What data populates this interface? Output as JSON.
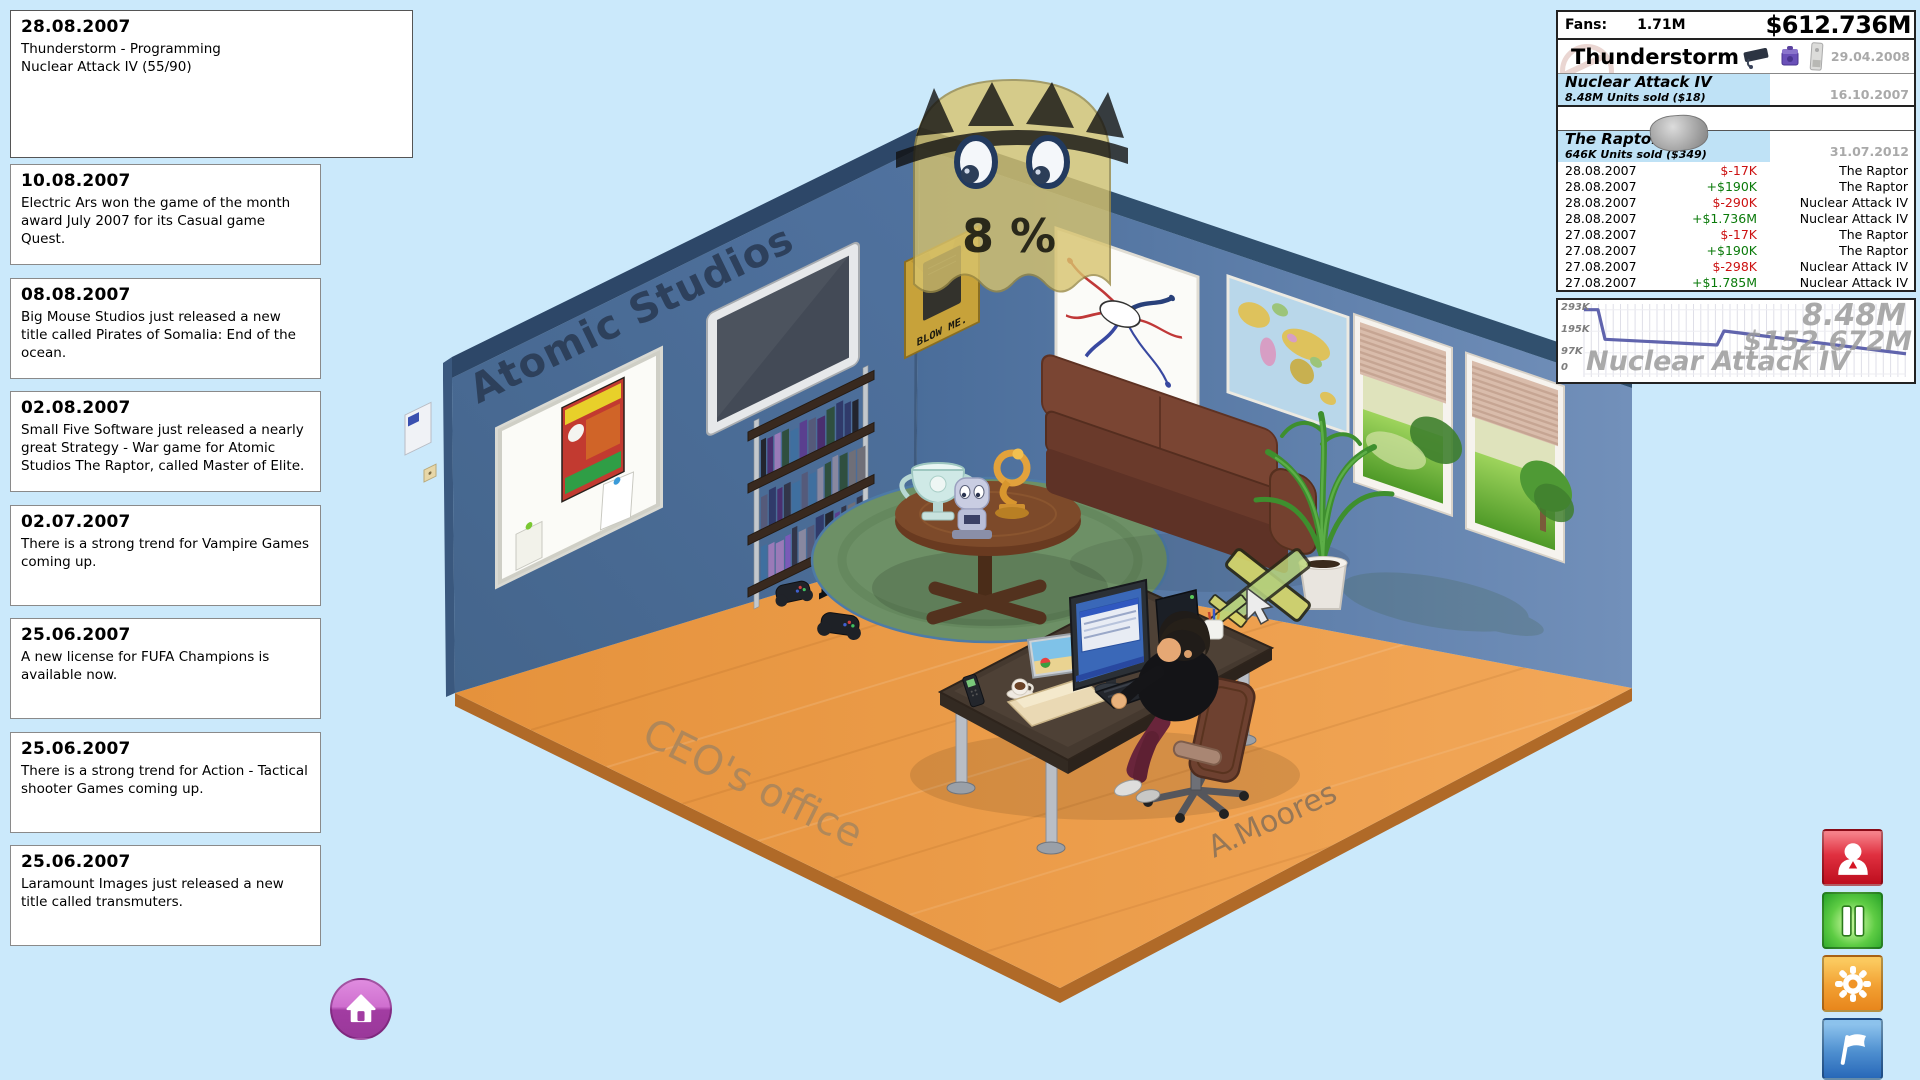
{
  "status_box": {
    "date": "28.08.2007",
    "line1": "Thunderstorm - Programming",
    "line2": "Nuclear Attack IV (55/90)"
  },
  "news": [
    {
      "date": "10.08.2007",
      "text": "Electric Ars won the game of the month award July 2007 for its Casual game Quest."
    },
    {
      "date": "08.08.2007",
      "text": "Big Mouse Studios just released a new title called Pirates of Somalia: End of the ocean."
    },
    {
      "date": "02.08.2007",
      "text": "Small Five Software just released a nearly great Strategy - War game for Atomic Studios The Raptor, called Master of Elite."
    },
    {
      "date": "02.07.2007",
      "text": "There is a strong trend for Vampire Games coming up."
    },
    {
      "date": "25.06.2007",
      "text": "A new license for FUFA Champions is available now."
    },
    {
      "date": "25.06.2007",
      "text": "There is a strong trend for Action - Tactical shooter Games coming up."
    },
    {
      "date": "25.06.2007",
      "text": "Laramount Images just released a new title called transmuters."
    }
  ],
  "stats_panel": {
    "fans_label": "Fans:",
    "fans_value": "1.71M",
    "cash": "$612.736M",
    "company_name": "Thunderstorm",
    "company_date": "29.04.2008",
    "platform_icons": [
      "playstation-console-icon",
      "gamecube-console-icon",
      "xbox-console-icon"
    ],
    "games": [
      {
        "name": "Nuclear Attack IV",
        "units": "8.48M Units sold ($18)",
        "date": "16.10.2007"
      },
      {
        "name": "The Raptor",
        "units": "646K Units sold ($349)",
        "date": "31.07.2012"
      }
    ],
    "transactions": [
      {
        "date": "28.08.2007",
        "amount": "$-17K",
        "cls": "tx-amt neg",
        "game": "The Raptor"
      },
      {
        "date": "28.08.2007",
        "amount": "+$190K",
        "cls": "tx-amt pos",
        "game": "The Raptor"
      },
      {
        "date": "28.08.2007",
        "amount": "$-290K",
        "cls": "tx-amt neg",
        "game": "Nuclear Attack IV"
      },
      {
        "date": "28.08.2007",
        "amount": "+$1.736M",
        "cls": "tx-amt pos",
        "game": "Nuclear Attack IV"
      },
      {
        "date": "27.08.2007",
        "amount": "$-17K",
        "cls": "tx-amt neg",
        "game": "The Raptor"
      },
      {
        "date": "27.08.2007",
        "amount": "+$190K",
        "cls": "tx-amt pos",
        "game": "The Raptor"
      },
      {
        "date": "27.08.2007",
        "amount": "$-298K",
        "cls": "tx-amt neg",
        "game": "Nuclear Attack IV"
      },
      {
        "date": "27.08.2007",
        "amount": "+$1.785M",
        "cls": "tx-amt pos",
        "game": "Nuclear Attack IV"
      }
    ]
  },
  "chart_data": {
    "type": "line",
    "title": "Nuclear Attack IV",
    "watermark_units": "8.48M",
    "watermark_revenue": "$152.672M",
    "y_tick_labels": [
      "293K",
      "195K",
      "97K",
      "0"
    ],
    "y_ticks_values": [
      293000,
      195000,
      97000,
      0
    ],
    "ylim": [
      0,
      310000
    ],
    "x_max_weeks": 46,
    "grid": "vertical",
    "legend_position": "none",
    "series": [
      {
        "name": "Nuclear Attack IV weekly unit sales",
        "x_weeks": [
          0,
          2,
          3,
          19,
          20,
          46
        ],
        "y_units": [
          293000,
          293000,
          158000,
          132000,
          196000,
          92000
        ]
      }
    ]
  },
  "scene": {
    "studio_name": "Atomic Studios",
    "room_label": "CEO's office",
    "desk_owner": "A.Moores",
    "poster_text": "BLOW ME.",
    "hype_label": "8 %"
  },
  "controls": {
    "home_button_icon": "home-icon",
    "side_buttons": [
      {
        "name": "staff",
        "icon": "person-icon",
        "color": "#d41624"
      },
      {
        "name": "pause",
        "icon": "pause-icon",
        "color": "#2fae2f"
      },
      {
        "name": "settings",
        "icon": "gear-icon",
        "color": "#f09428"
      },
      {
        "name": "report",
        "icon": "flag-icon",
        "color": "#3f7fc4"
      }
    ]
  },
  "colors": {
    "background": "#cbe9fb",
    "floor": "#ed9d4e",
    "wall": "#4a6d9a",
    "row_highlight": "#bfe2f6",
    "negative": "#cc1111",
    "positive": "#0a7a0a",
    "chart_line": "#6064ad"
  }
}
